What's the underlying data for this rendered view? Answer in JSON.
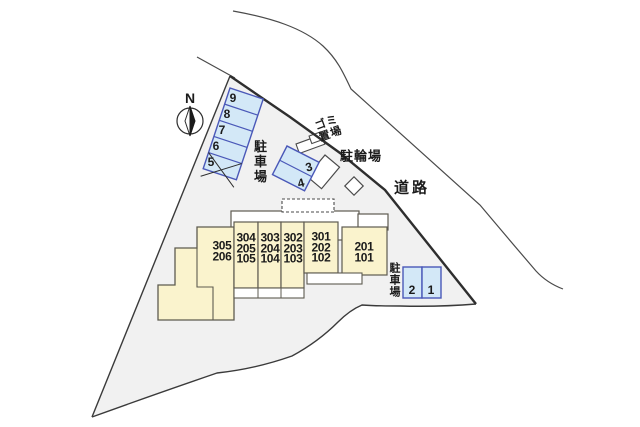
{
  "plan": {
    "compass": {
      "label": "N"
    },
    "road_label": "道路",
    "garbage_area_label": "ゴミ\n置場",
    "bicycle_parking_label": "駐輪場",
    "parking_lot_left_label": "駐車場",
    "parking_lot_right_label": "駐車場",
    "parking_spaces_left": [
      "9",
      "8",
      "7",
      "6",
      "5"
    ],
    "parking_spaces_middle": [
      "3",
      "4"
    ],
    "parking_spaces_right": [
      "2",
      "1"
    ],
    "building_units": [
      {
        "label": "305\n206"
      },
      {
        "label": "304\n205\n105"
      },
      {
        "label": "303\n204\n104"
      },
      {
        "label": "302\n203\n103"
      },
      {
        "label": "301\n202\n102"
      },
      {
        "label": "201\n101"
      }
    ],
    "colors": {
      "site_fill": "#f1f1f1",
      "building_fill": "#faf3cd",
      "parking_fill": "#d3e8f7",
      "parking_border": "#4a58b8",
      "line": "#3a3a3a",
      "white": "#ffffff"
    }
  }
}
